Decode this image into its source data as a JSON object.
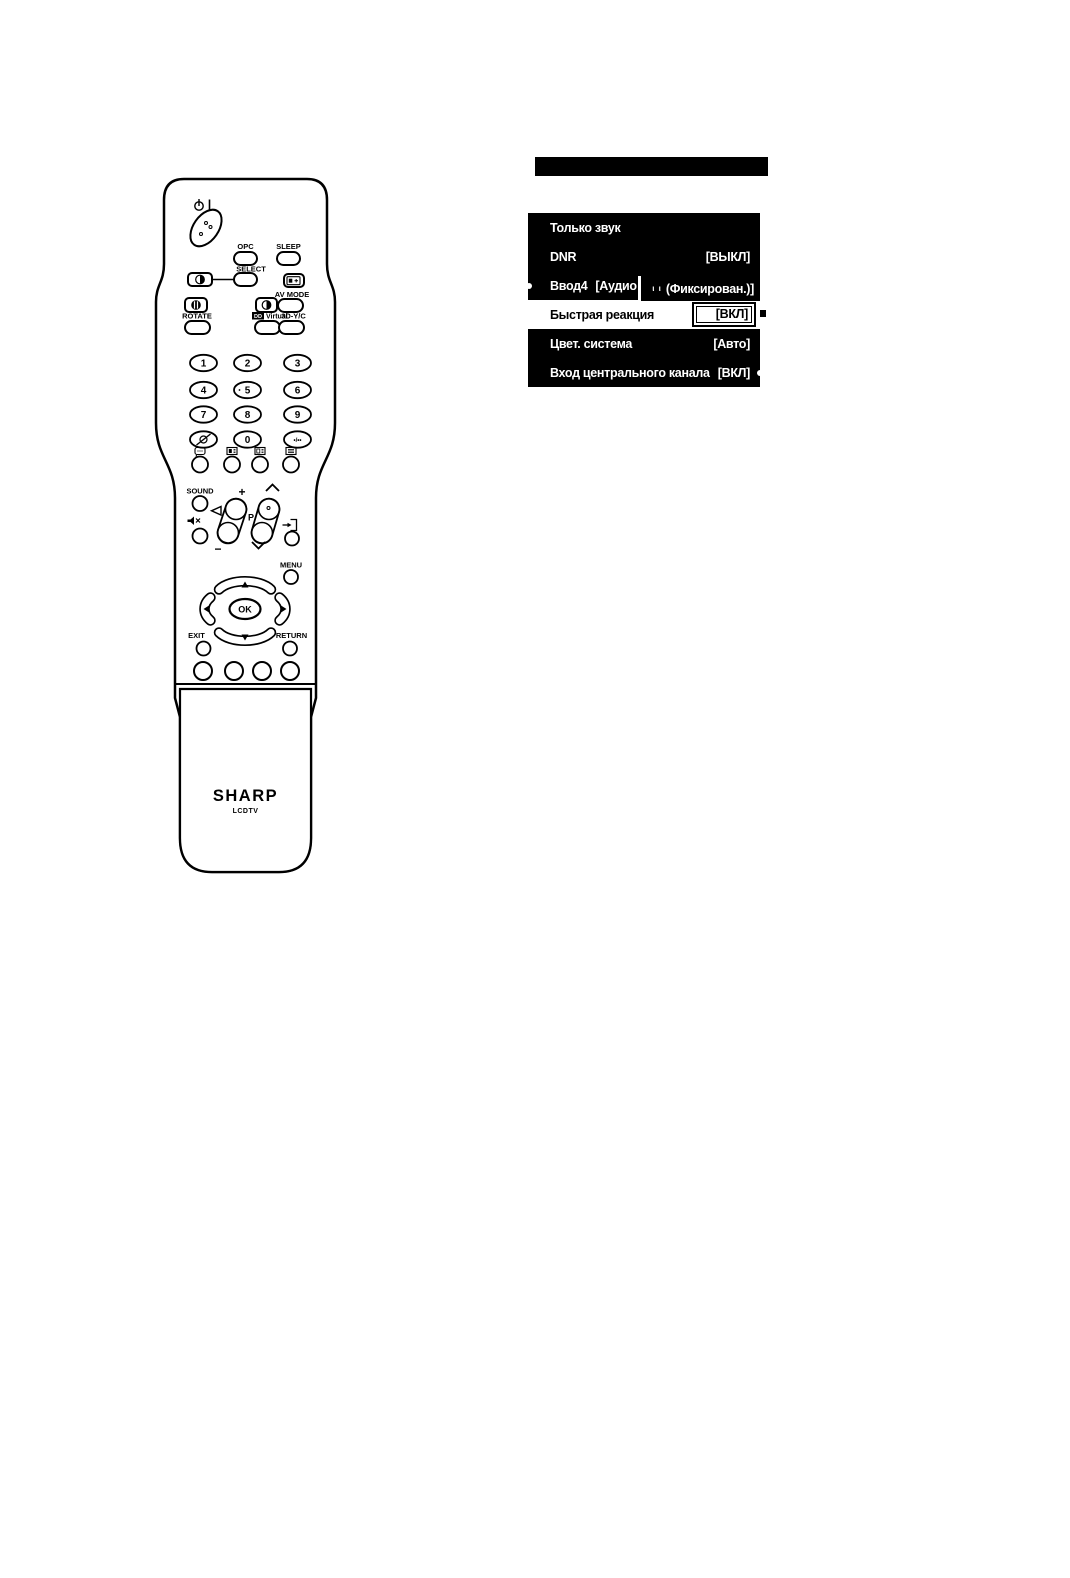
{
  "figure": {
    "remote": {
      "brand": "SHARP",
      "brand_sub": "LCDTV",
      "power_bar": "I",
      "labels": {
        "opc": "OPC",
        "sleep": "SLEEP",
        "select": "SELECT",
        "av_mode": "AV MODE",
        "rotate": "ROTATE",
        "dolby": "DD",
        "virtual": "Virtual",
        "yc": "3D-Y/C",
        "sound": "SOUND",
        "menu": "MENU",
        "exit": "EXIT",
        "return": "RETURN",
        "ok": "OK",
        "p": "P",
        "plus": "+",
        "minus": "−",
        "dot_slash": "•/••"
      },
      "digits": [
        "1",
        "2",
        "3",
        "4",
        "5",
        "6",
        "7",
        "8",
        "9"
      ],
      "zero": "0"
    },
    "osd_menu": {
      "colors": {
        "bg": "#000000",
        "fg": "#ffffff",
        "highlight_bg": "#ffffff",
        "highlight_fg": "#000000"
      },
      "items": [
        {
          "label": "Только звук",
          "value": ""
        },
        {
          "label": "DNR",
          "value": "[ВЫКЛ]"
        },
        {
          "label": "Ввод4",
          "value": "[Аудио в",
          "overlay_small": "ι ι",
          "overlay": "(Фиксирован.)]"
        },
        {
          "label": "Быстрая реакция",
          "value": "[ВКЛ]"
        },
        {
          "label": "Цвет. система",
          "value": "[Авто]"
        },
        {
          "label": "Вход центрального канала",
          "value": "[ВКЛ]"
        }
      ]
    }
  }
}
